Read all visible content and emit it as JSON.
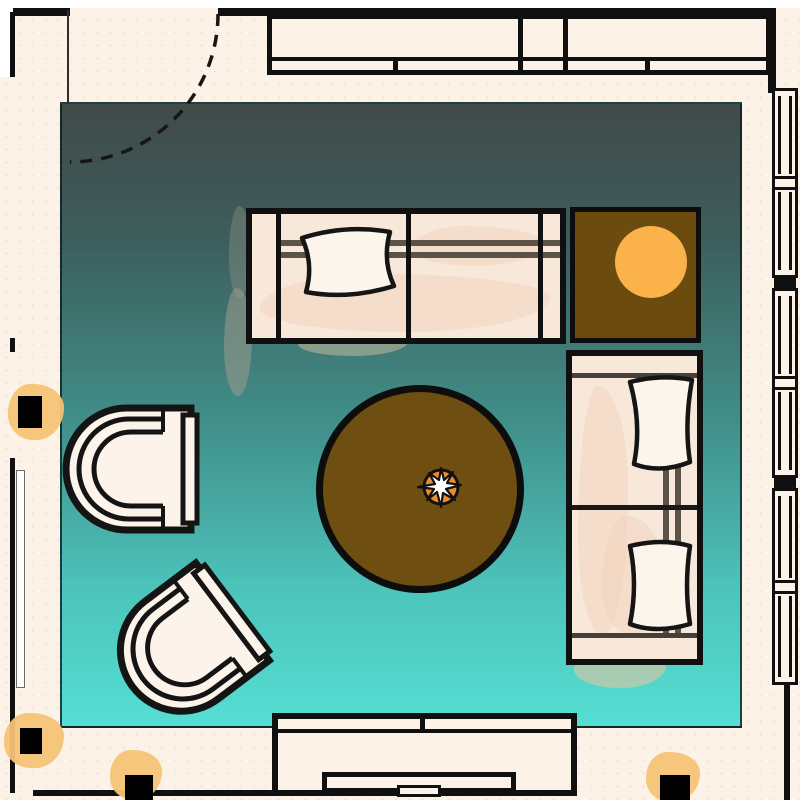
{
  "scene": {
    "kind": "living-room-floor-plan",
    "text_visible": false
  },
  "colors": {
    "cream": "#fdf2e8",
    "exterior": "#ffffff",
    "wall": "#101010",
    "floor-top": "#404a49",
    "floor-bottom": "#55ded3",
    "sofa": "#f8e8d9",
    "sofa-wash": "#f0d4bd",
    "pillow": "#fbf5ec",
    "frame": "#5b5348",
    "chair": "#fcf4ea",
    "rug": "#6f4e11",
    "table": "#6b4b0e",
    "lamp": "#fbb24b",
    "accent": "#ef8c2a",
    "glow": "#f6c377"
  },
  "architecture": {
    "door_top_left": {
      "type": "swing-door",
      "dashed_arc": true
    },
    "right_window_units": 3,
    "wall_cabinet_sections": 3,
    "sconces": 4
  },
  "furniture": [
    {
      "name": "wall-cabinet",
      "position": "top"
    },
    {
      "name": "sofa-horizontal",
      "pillows": 1
    },
    {
      "name": "side-table-with-lamp",
      "lamp_color": "#fbb24b"
    },
    {
      "name": "sofa-vertical",
      "pillows": 2
    },
    {
      "name": "round-rug",
      "color": "#6f4e11"
    },
    {
      "name": "centerpiece-plant",
      "color": "#ef8c2a"
    },
    {
      "name": "armchair-upper",
      "facing": "right"
    },
    {
      "name": "armchair-lower",
      "facing": "upper-right"
    },
    {
      "name": "media-console",
      "position": "bottom"
    }
  ]
}
